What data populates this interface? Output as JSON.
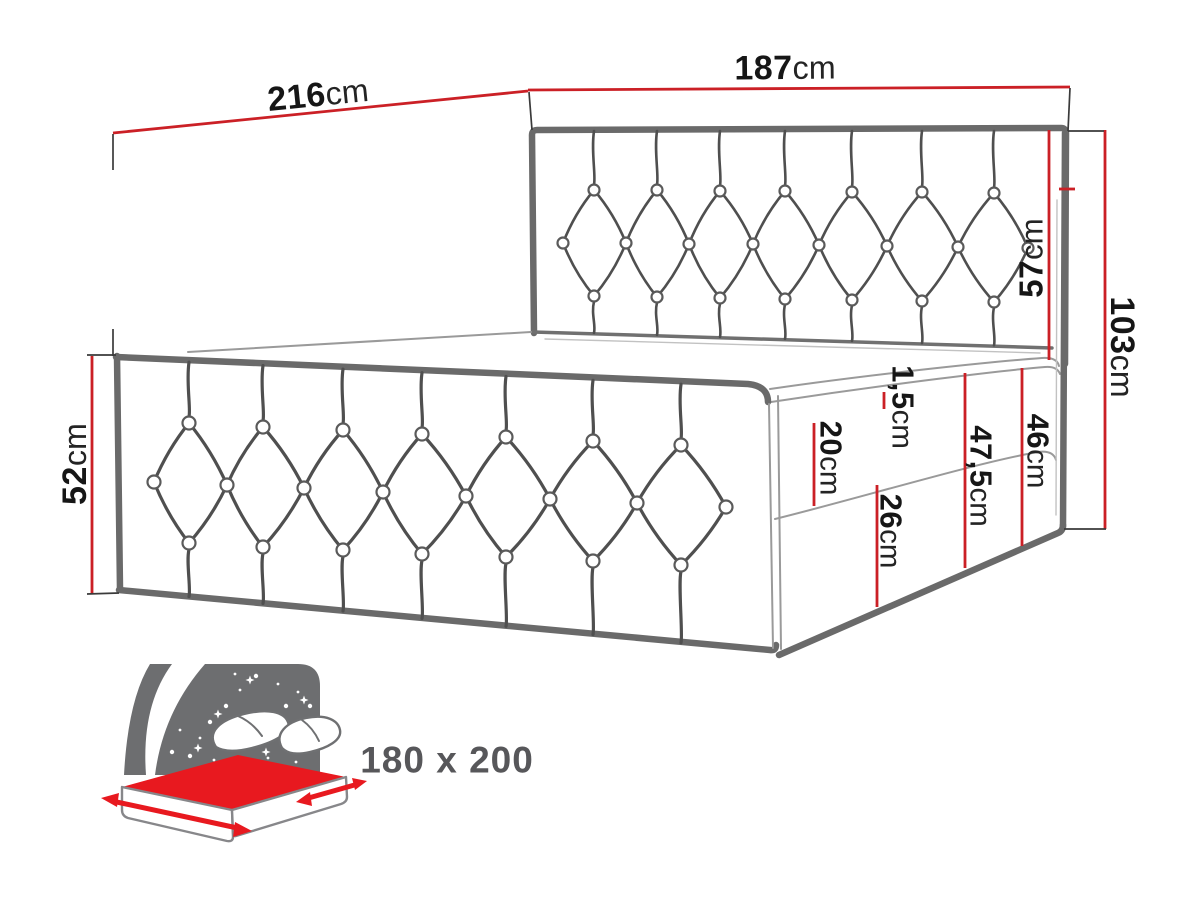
{
  "dimensions": {
    "outer_width": {
      "value": "216",
      "unit": "cm"
    },
    "inner_width": {
      "value": "187",
      "unit": "cm"
    },
    "headboard_above": {
      "value": "57",
      "unit": "cm"
    },
    "total_side_height": {
      "value": "103",
      "unit": "cm"
    },
    "footboard_height": {
      "value": "52",
      "unit": "cm"
    },
    "mattress_seam": {
      "value": "1,5",
      "unit": "cm"
    },
    "mattress_thickness": {
      "value": "20",
      "unit": "cm"
    },
    "side_full_height": {
      "value": "47,5",
      "unit": "cm"
    },
    "side_upper_height": {
      "value": "46",
      "unit": "cm"
    },
    "base_height": {
      "value": "26",
      "unit": "cm"
    }
  },
  "size_icon": {
    "name": "bed-size-icon",
    "label": "180 x 200"
  },
  "colors": {
    "dimension_red": "#cb2026",
    "icon_red": "#e8191f",
    "icon_gray": "#6d6e70",
    "outline_gray": "#6a6a6a",
    "tuft_gray": "#4f4f4f",
    "label_black": "#161616",
    "size_text_gray": "#57575a"
  }
}
